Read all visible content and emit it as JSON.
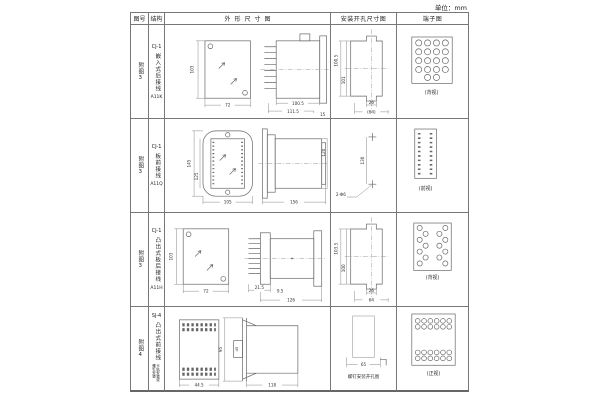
{
  "unit_note": "单位：mm",
  "header": {
    "fig": "图号",
    "structure": "结构",
    "outline": "外形尺寸图",
    "mounting": "安装开孔尺寸图",
    "terminal": "端子图"
  },
  "rows": [
    {
      "fig": "附图3",
      "model": "CJ-1",
      "structure": "嵌入式后接线",
      "code": "A11K",
      "outline": {
        "front_h": "103",
        "front_w": "72",
        "body_l": "100.5",
        "total_l": "111.5",
        "flange": "15"
      },
      "mounting": {
        "v1": "100.5",
        "v2": "101",
        "w1": "26",
        "w2": "(64)"
      },
      "terminal_label": "(背视)"
    },
    {
      "fig": "附图3",
      "model": "CJ-1",
      "structure": "板前接线",
      "code": "A11Q",
      "outline": {
        "front_h": "145",
        "inner_h": "125",
        "front_w": "105",
        "body_l": "156",
        "side_h": "120"
      },
      "mounting": {
        "v1": "130",
        "note": "2-Φ6"
      },
      "terminal_label": "(前视)"
    },
    {
      "fig": "附图3",
      "model": "CJ-1",
      "structure": "凸出式板后接线",
      "code": "A11H",
      "outline": {
        "front_h": "103",
        "front_w": "72",
        "fin_l": "21.5",
        "plate": "9.5",
        "total_l": "126"
      },
      "mounting": {
        "v1": "103.5",
        "v2": "100",
        "w1": "26",
        "w2": "64"
      },
      "terminal_label": "(背视)"
    },
    {
      "fig": "附图4",
      "model": "SJ-4",
      "structure": "凸出式前接线",
      "note": "卡轨安装或螺钉安装",
      "outline": {
        "front_w": "44.5",
        "side_h": "95",
        "inner": "45",
        "body_l": "118"
      },
      "mounting": {
        "w1": "65",
        "caption": "螺钉安装开孔图"
      },
      "terminal_label": "(正视)"
    }
  ]
}
